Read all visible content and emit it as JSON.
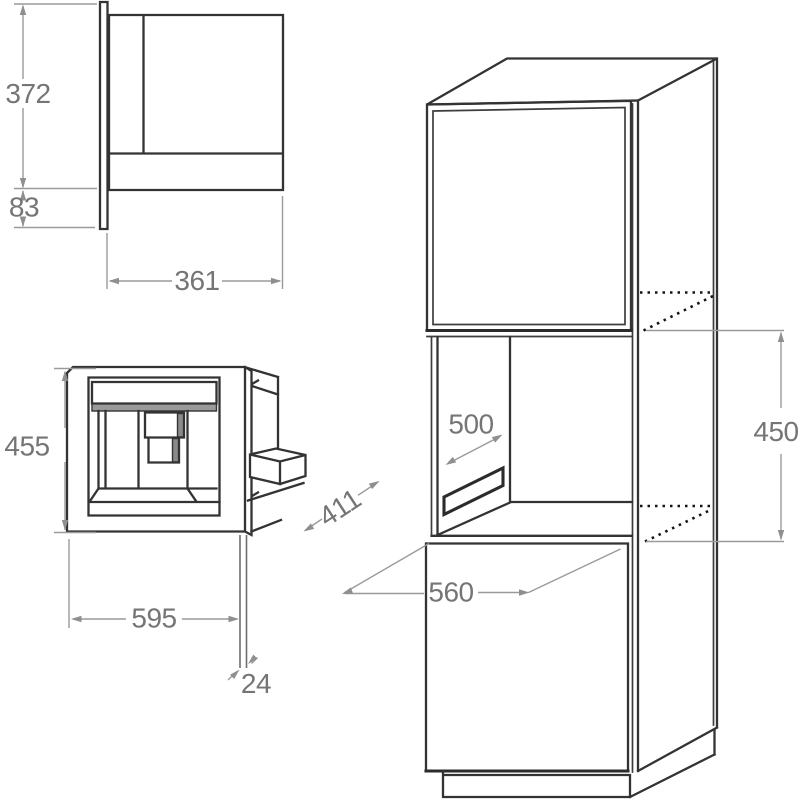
{
  "dims": {
    "side_view": {
      "body_height": "372",
      "lower_height": "83",
      "body_depth": "361"
    },
    "front_view": {
      "front_height": "455",
      "front_width": "595",
      "panel_thickness": "24",
      "total_depth": "411"
    },
    "cabinet_view": {
      "niche_depth": "500",
      "carcass_depth": "560",
      "niche_height": "450"
    }
  },
  "colors": {
    "background": "#ffffff",
    "drawing_line": "#333333",
    "dimension_line": "#9a9a9a",
    "label_text": "#757575",
    "shaded_fill": "#9a9a9a"
  }
}
